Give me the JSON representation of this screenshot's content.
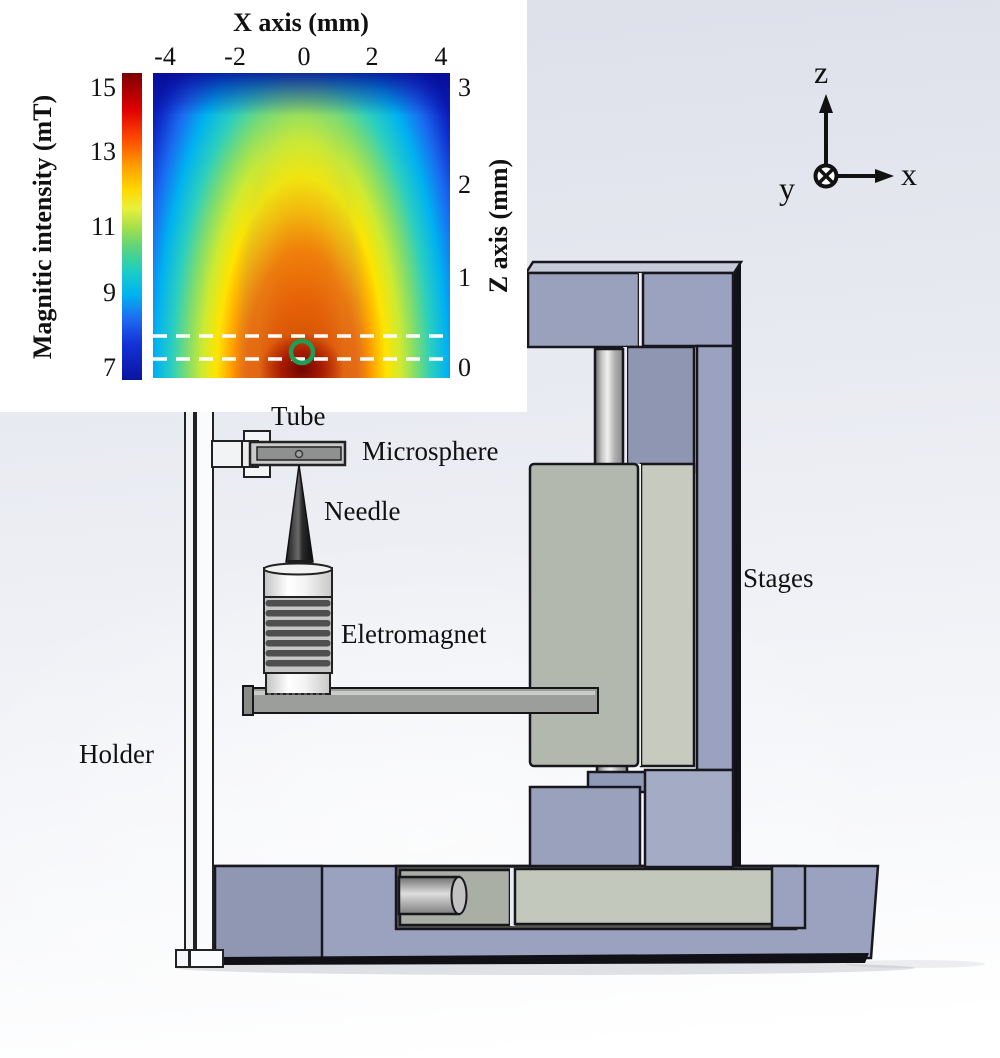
{
  "inset": {
    "x_axis_title": "X axis (mm)",
    "x_ticks": [
      "-4",
      "-2",
      "0",
      "2",
      "4"
    ],
    "z_axis_title": "Z axis (mm)",
    "z_ticks": [
      "3",
      "2",
      "1",
      "0"
    ],
    "colorbar_title": "Magnitic intensity (mT)",
    "colorbar_ticks": [
      "15",
      "13",
      "11",
      "9",
      "7"
    ]
  },
  "annotations": {
    "tube": "Tube",
    "microsphere": "Microsphere",
    "needle": "Needle",
    "electromagnet": "Eletromagnet",
    "stages": "Stages",
    "holder": "Holder"
  },
  "axes_indicator": {
    "up": "z",
    "right": "x",
    "into_page": "y"
  },
  "colors": {
    "stage_lavender": "#99a1bd",
    "stage_lavender_light": "#a6adc6",
    "carriage_gray_green": "#b2b8ad",
    "carriage_side": "#c6cabf",
    "heat_max": "#7f0000",
    "heat_min": "#0a14a0",
    "marker_green": "#1e9e55",
    "dashed_line": "#ffffff"
  },
  "chart_data": {
    "type": "heatmap",
    "title": "Magnetic intensity map near the electromagnet needle tip",
    "xlabel": "X axis (mm)",
    "ylabel": "Z axis (mm)",
    "colorbar_label": "Magnitic intensity (mT)",
    "colormap": "jet",
    "x_range": [
      -4,
      4
    ],
    "z_range": [
      0,
      3
    ],
    "intensity_range_mT": [
      7,
      15
    ],
    "x": [
      -4,
      -3,
      -2,
      -1,
      0,
      1,
      2,
      3,
      4
    ],
    "z": [
      3,
      2.5,
      2,
      1.5,
      1,
      0.5,
      0
    ],
    "values_mT_estimated": [
      [
        7.5,
        8,
        9,
        10,
        10.5,
        10,
        9,
        8,
        7.5
      ],
      [
        8,
        8.5,
        9.5,
        11,
        12,
        11,
        9.5,
        8.5,
        8
      ],
      [
        8,
        9,
        10,
        12,
        13,
        12,
        10,
        9,
        8
      ],
      [
        8.5,
        9,
        10.5,
        12.5,
        13.5,
        12.5,
        10.5,
        9,
        8.5
      ],
      [
        8.5,
        9.5,
        11,
        13,
        14,
        13,
        11,
        9.5,
        8.5
      ],
      [
        8.5,
        9.5,
        11,
        13.5,
        14.5,
        13.5,
        11,
        9.5,
        8.5
      ],
      [
        8.5,
        10,
        11.5,
        14,
        15,
        14,
        11.5,
        10,
        8.5
      ]
    ],
    "overlay_annotations": {
      "dashed_lines_z_mm": [
        0.35,
        0.1
      ],
      "target_marker": {
        "x_mm": 0,
        "z_mm": 0.15,
        "style": "green circle outline"
      }
    },
    "legend_position": "left colorbar",
    "grid": false
  }
}
